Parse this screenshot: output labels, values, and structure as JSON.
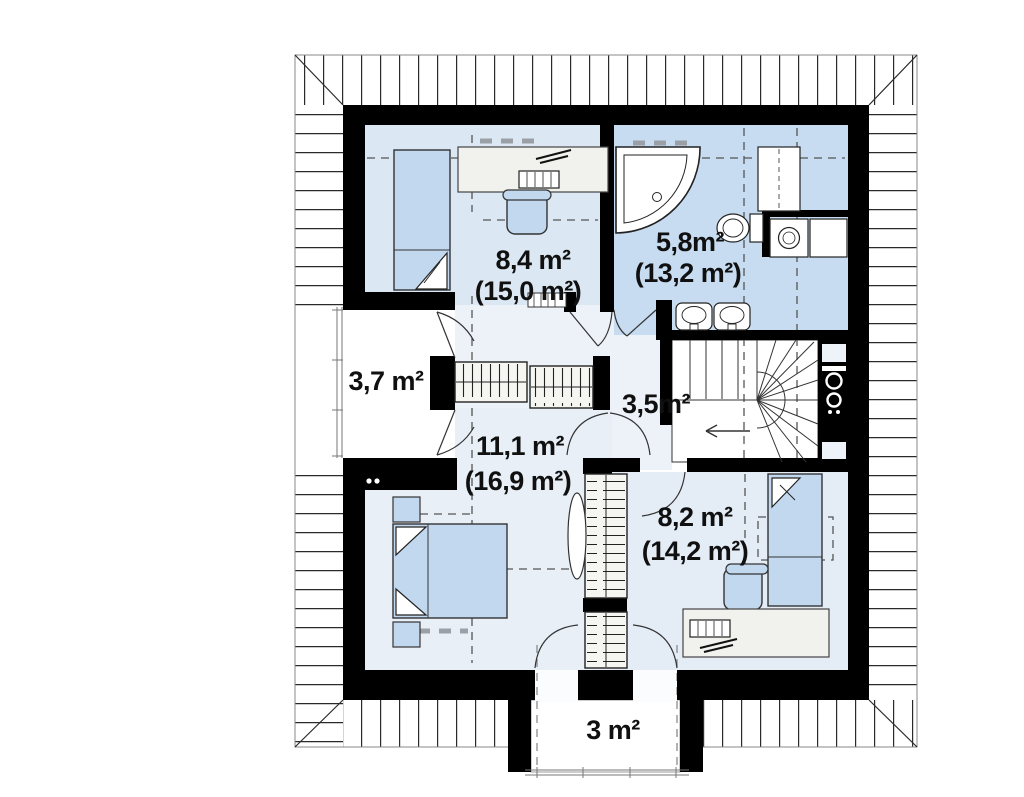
{
  "plan": {
    "title": "attic-floor-plan",
    "rooms": [
      {
        "key": "bedroom-top-left",
        "area": "8,4 m²",
        "area_full": "(15,0 m²)"
      },
      {
        "key": "bathroom",
        "area": "5,8m²",
        "area_full": "(13,2 m²)"
      },
      {
        "key": "balcony-left",
        "area": "3,7 m²"
      },
      {
        "key": "hall",
        "area": "3,5m²"
      },
      {
        "key": "bedroom-bottom-left",
        "area": "11,1 m²",
        "area_full": "(16,9 m²)"
      },
      {
        "key": "bedroom-bottom-right",
        "area": "8,2 m²",
        "area_full": "(14,2 m²)"
      },
      {
        "key": "balcony-bottom",
        "area": "3 m²"
      }
    ],
    "colors": {
      "wall": "#000000",
      "roof_line": "#333333",
      "floor_bedroom1": "#dbe7f3",
      "floor_bathroom": "#c7dcf0",
      "floor_bedroom2": "#e9eff7",
      "floor_bedroom3": "#e4ecf6",
      "floor_hall": "#edf2f9",
      "furniture_blue": "#c2d8ef",
      "furniture_gray": "#f1f1ee"
    }
  }
}
